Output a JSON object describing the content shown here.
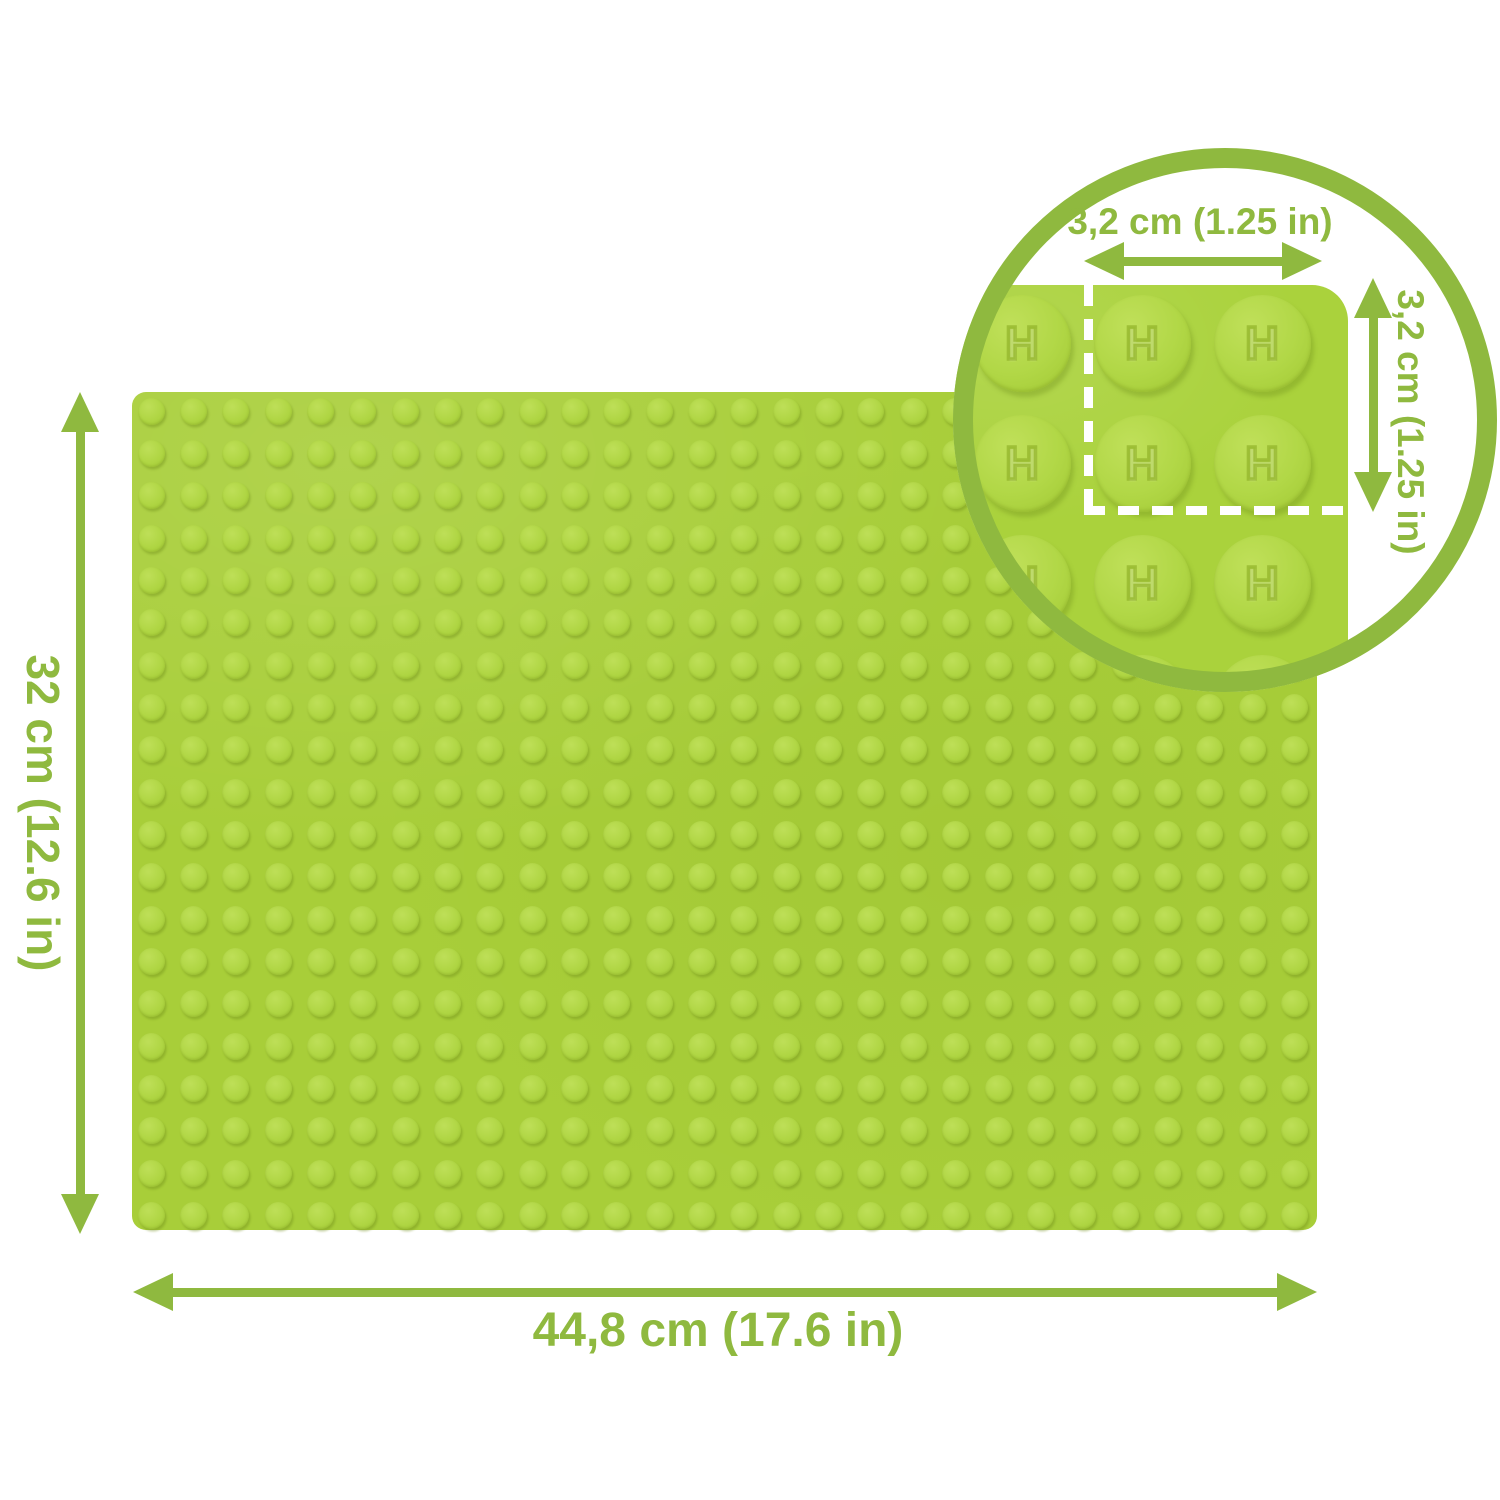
{
  "dimensions": {
    "height_label": "32 cm (12.6 in)",
    "width_label": "44,8 cm (17.6 in)"
  },
  "inset": {
    "stud_pitch_width_label": "3,2 cm (1.25 in)",
    "stud_pitch_height_label": "3,2 cm (1.25 in)",
    "stud_logo": "H",
    "grid": {
      "cols": 3,
      "rows": 4
    }
  },
  "plate": {
    "grid": {
      "cols": 28,
      "rows": 20
    }
  },
  "colors": {
    "annotation_green": "#8fb93f",
    "plate_green": "#a8ce39",
    "inset_plate_green": "#aad23c",
    "stud_green": "#b0d644",
    "dash_white": "#ffffff",
    "background": "#ffffff"
  }
}
